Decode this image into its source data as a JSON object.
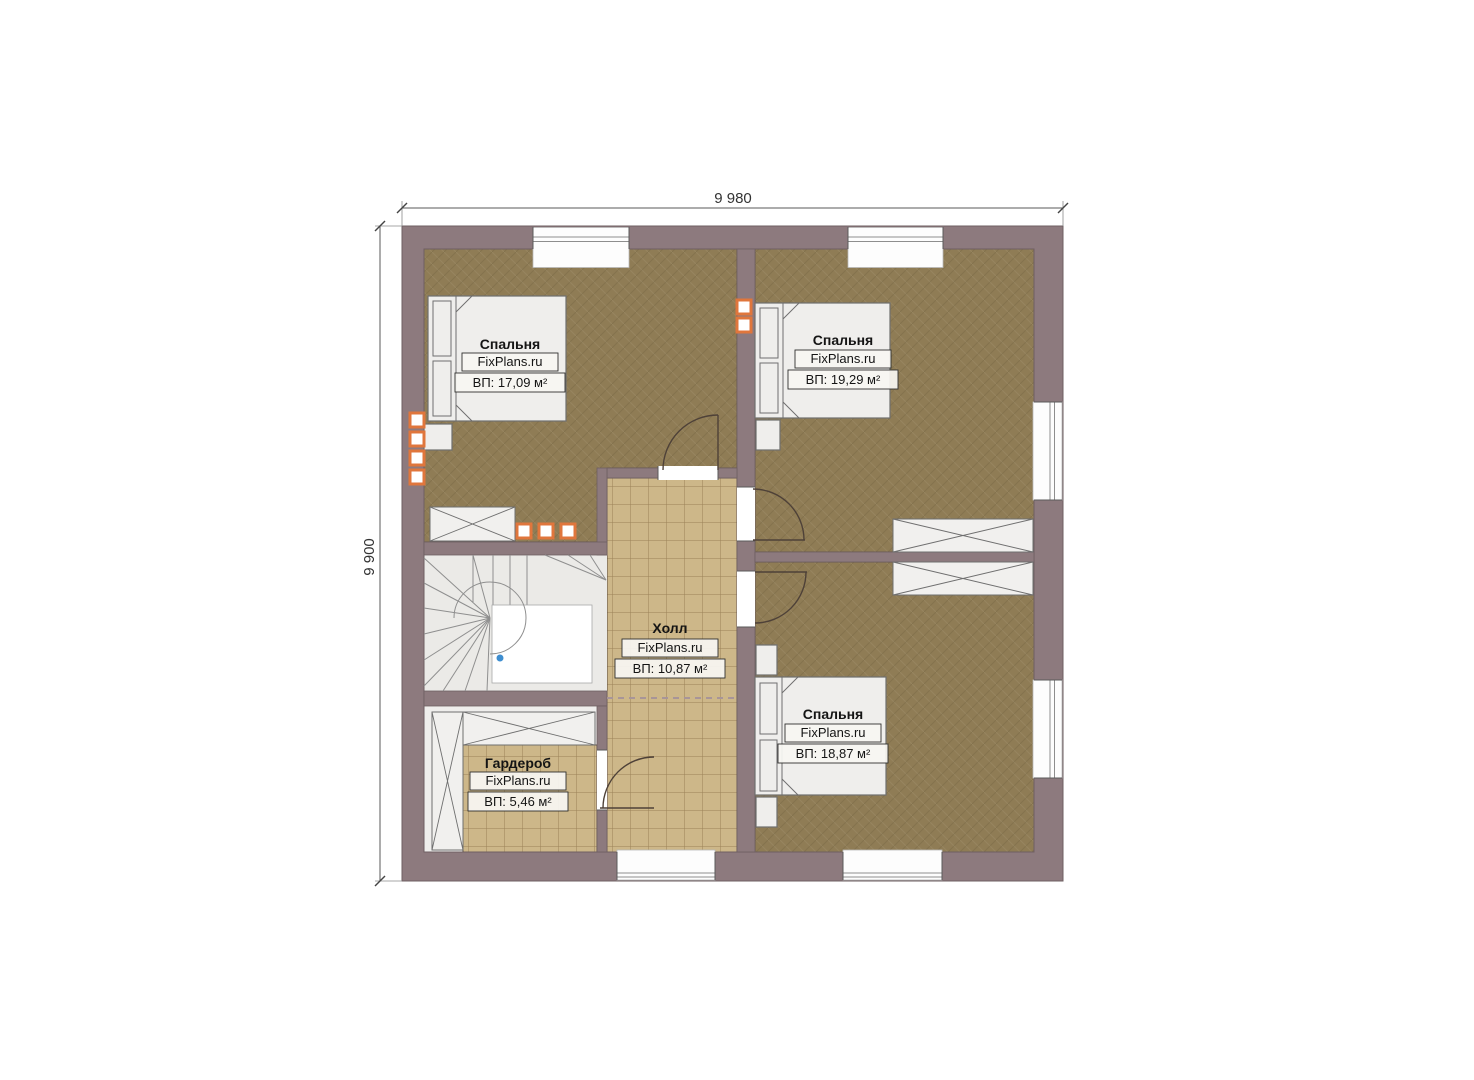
{
  "colors": {
    "wall": "#8d7a7e",
    "wall-line": "#6e5f62",
    "carpet": "#8f7c55",
    "tile": "#cdb789",
    "tile-line": "#9a8258",
    "furn": "#efeeec",
    "furn-line": "#6f6f6f",
    "door": "#4e4138",
    "radiator": "#e0763c",
    "dot": "#3e8ed0",
    "label-box": "#f7f6f2",
    "label-border": "#30302e",
    "text": "#141414"
  },
  "dimensions": {
    "top": "9 980",
    "left": "9 900"
  },
  "rooms": [
    {
      "name": "Спальня",
      "brand": "FixPlans.ru",
      "area": "ВП: 17,09 м²"
    },
    {
      "name": "Спальня",
      "brand": "FixPlans.ru",
      "area": "ВП: 19,29 м²"
    },
    {
      "name": "Холл",
      "brand": "FixPlans.ru",
      "area": "ВП: 10,87 м²"
    },
    {
      "name": "Спальня",
      "brand": "FixPlans.ru",
      "area": "ВП: 18,87 м²"
    },
    {
      "name": "Гардероб",
      "brand": "FixPlans.ru",
      "area": "ВП: 5,46 м²"
    }
  ]
}
